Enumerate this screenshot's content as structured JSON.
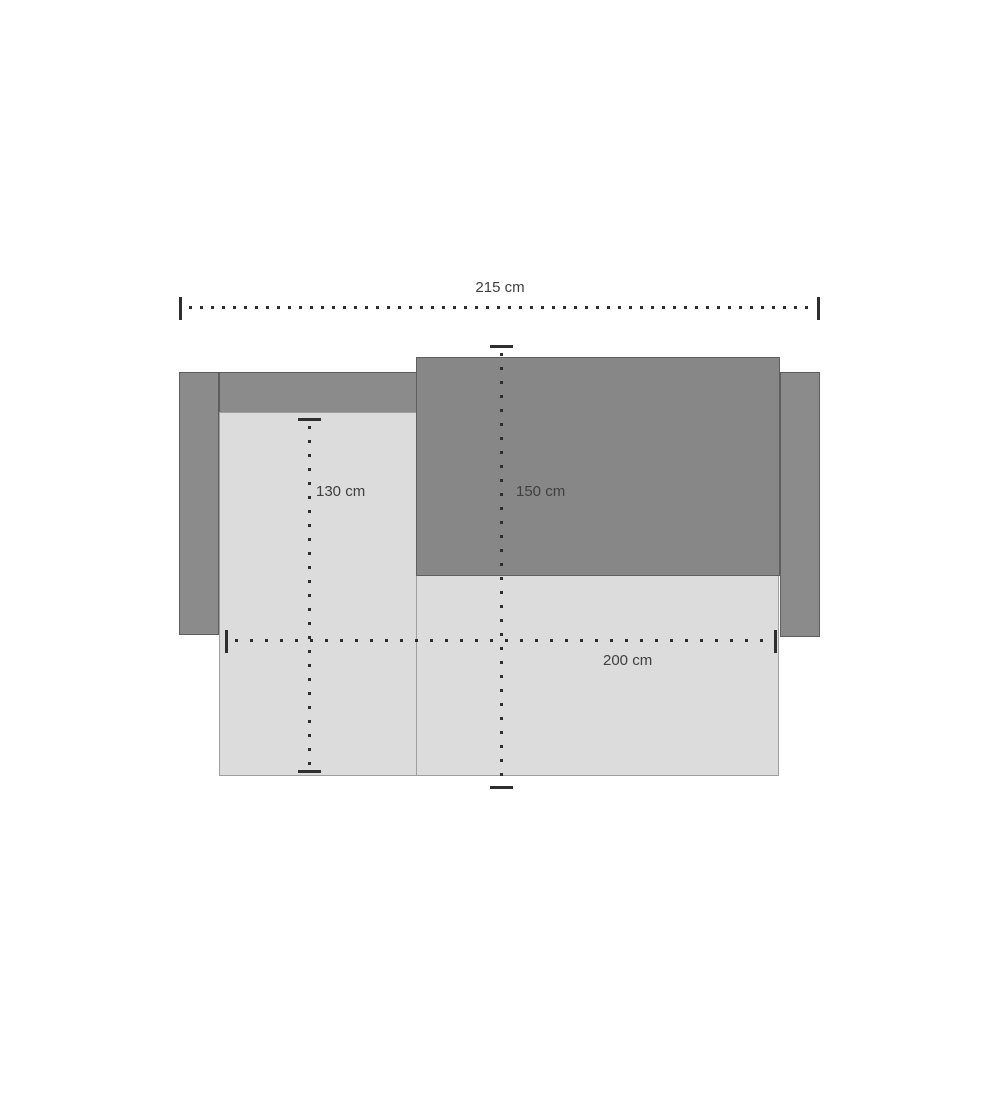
{
  "measurements": {
    "overall_width": {
      "label": "215 cm"
    },
    "chaise_depth": {
      "label": "130 cm"
    },
    "bed_depth": {
      "label": "150 cm"
    },
    "inner_width": {
      "label": "200 cm"
    }
  },
  "colors": {
    "upholstery_dark": "#8b8b8b",
    "mattress_fill": "#878787",
    "seat_light": "#dcdcdc",
    "outline_dark": "#5e5e5e",
    "outline_light": "#9f9f9f",
    "dim_line": "#2e2e2e",
    "text_color": "#3f3f3f",
    "bg": "#ffffff"
  }
}
